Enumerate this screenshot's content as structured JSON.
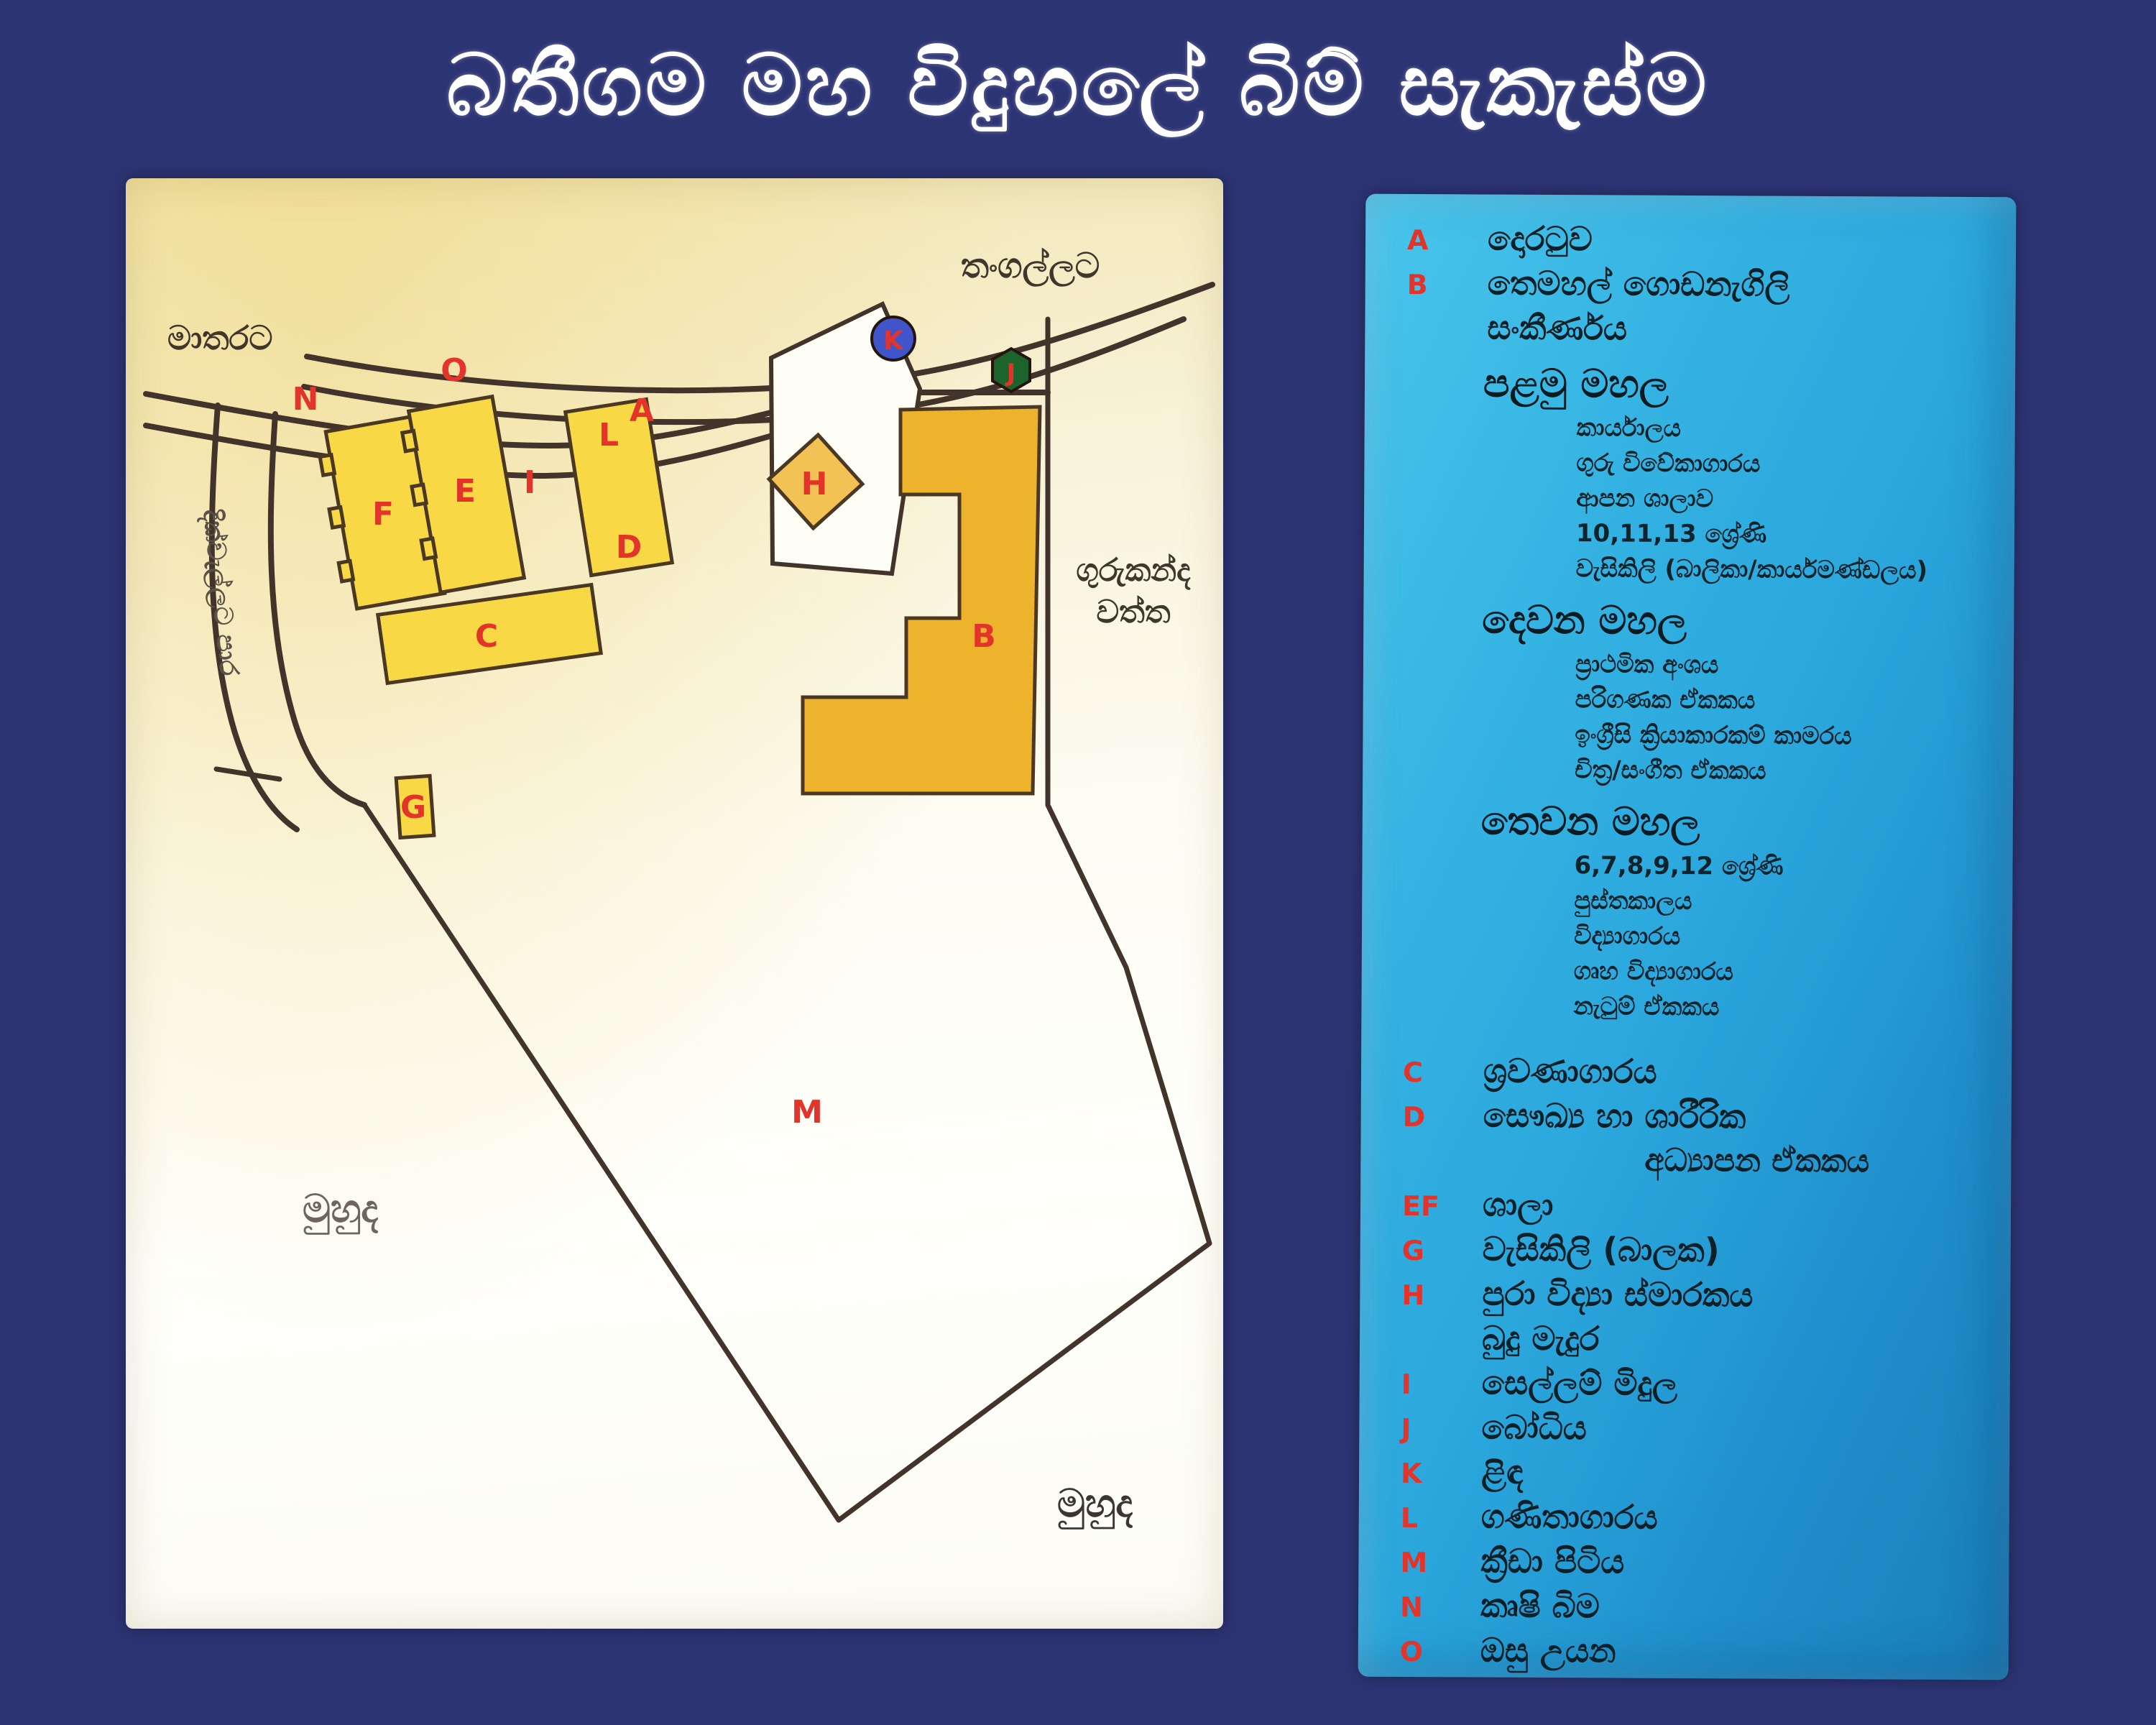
{
  "title": "බතීගම මහ විදුහලේ බිම් සැකැස්ම",
  "colors": {
    "background": "#2d3474",
    "map_paper": "#fbf7e6",
    "legend_paper": "#2aa6dc",
    "road_line": "#42342a",
    "building_yellow": "#f8d844",
    "building_b_gold": "#edb32d",
    "building_h_gold": "#f3c255",
    "marker_red": "#e2342b",
    "well_blue": "#3f55c9",
    "bodhi_green": "#1c642c"
  },
  "map": {
    "road_labels": {
      "to_matara": "මාතරට",
      "to_tangalle": "තංගල්ලට",
      "side_road": "දික්වැල්ලට පාර"
    },
    "area_labels": {
      "gurukanda_line1": "ගුරුකන්ද",
      "gurukanda_line2": "වත්ත",
      "sea_left": "මුහුද",
      "sea_right": "මුහුද"
    },
    "markers": {
      "a": "A",
      "b": "B",
      "c": "C",
      "d": "D",
      "e": "E",
      "f": "F",
      "g": "G",
      "h": "H",
      "i": "I",
      "j": "J",
      "k": "K",
      "l": "L",
      "m": "M",
      "n": "N",
      "o": "O"
    }
  },
  "legend": {
    "rows": [
      {
        "letter": "A",
        "text": "දොරටුව"
      },
      {
        "letter": "B",
        "text": "තෙමහල් ගොඩනැගිලි"
      },
      {
        "letter": "",
        "text": "සංකීර්ණය"
      },
      {
        "letter": "",
        "text": "පළමු මහල"
      },
      {
        "letter": "",
        "text": "කාර්යාලය"
      },
      {
        "letter": "",
        "text": "ගුරු විවේකාගාරය"
      },
      {
        "letter": "",
        "text": "ආපන ශාලාව"
      },
      {
        "letter": "",
        "text": "10,11,13 ශ්‍රේණි"
      },
      {
        "letter": "",
        "text": "වැසිකිලි (බාලිකා/කාර්යමණ්ඩලය)"
      },
      {
        "letter": "",
        "text": "දෙවන මහල"
      },
      {
        "letter": "",
        "text": "ප්‍රාථමික අංශය"
      },
      {
        "letter": "",
        "text": "පරිගණක ඒකකය"
      },
      {
        "letter": "",
        "text": "ඉංග්‍රීසි ක්‍රියාකාරකම් කාමරය"
      },
      {
        "letter": "",
        "text": "චිත්‍ර/සංගීත ඒකකය"
      },
      {
        "letter": "",
        "text": "තෙවන මහල"
      },
      {
        "letter": "",
        "text": "6,7,8,9,12 ශ්‍රේණි"
      },
      {
        "letter": "",
        "text": "පුස්තකාලය"
      },
      {
        "letter": "",
        "text": "විද්‍යාගාරය"
      },
      {
        "letter": "",
        "text": "ගෘහ විද්‍යාගාරය"
      },
      {
        "letter": "",
        "text": "නැටුම් ඒකකය"
      },
      {
        "letter": "C",
        "text": "ශ්‍රවණාගාරය"
      },
      {
        "letter": "D",
        "text": "සෞඛ්‍ය හා ශාරීරික"
      },
      {
        "letter": "",
        "text": "අධ්‍යාපන ඒකකය"
      },
      {
        "letter": "EF",
        "text": "ශාලා"
      },
      {
        "letter": "G",
        "text": "වැසිකිලි (බාලක)"
      },
      {
        "letter": "H",
        "text": "පුරා විද්‍යා ස්මාරකය"
      },
      {
        "letter": "",
        "text": "බුදු මැදුර"
      },
      {
        "letter": "I",
        "text": "සෙල්ලම් මිදුල"
      },
      {
        "letter": "J",
        "text": "බෝධිය"
      },
      {
        "letter": "K",
        "text": "ළිඳ"
      },
      {
        "letter": "L",
        "text": "ගණිතාගාරය"
      },
      {
        "letter": "M",
        "text": "ක්‍රීඩා පිටිය"
      },
      {
        "letter": "N",
        "text": "කෘෂි බිම"
      },
      {
        "letter": "O",
        "text": "ඔසු උයන"
      }
    ]
  }
}
